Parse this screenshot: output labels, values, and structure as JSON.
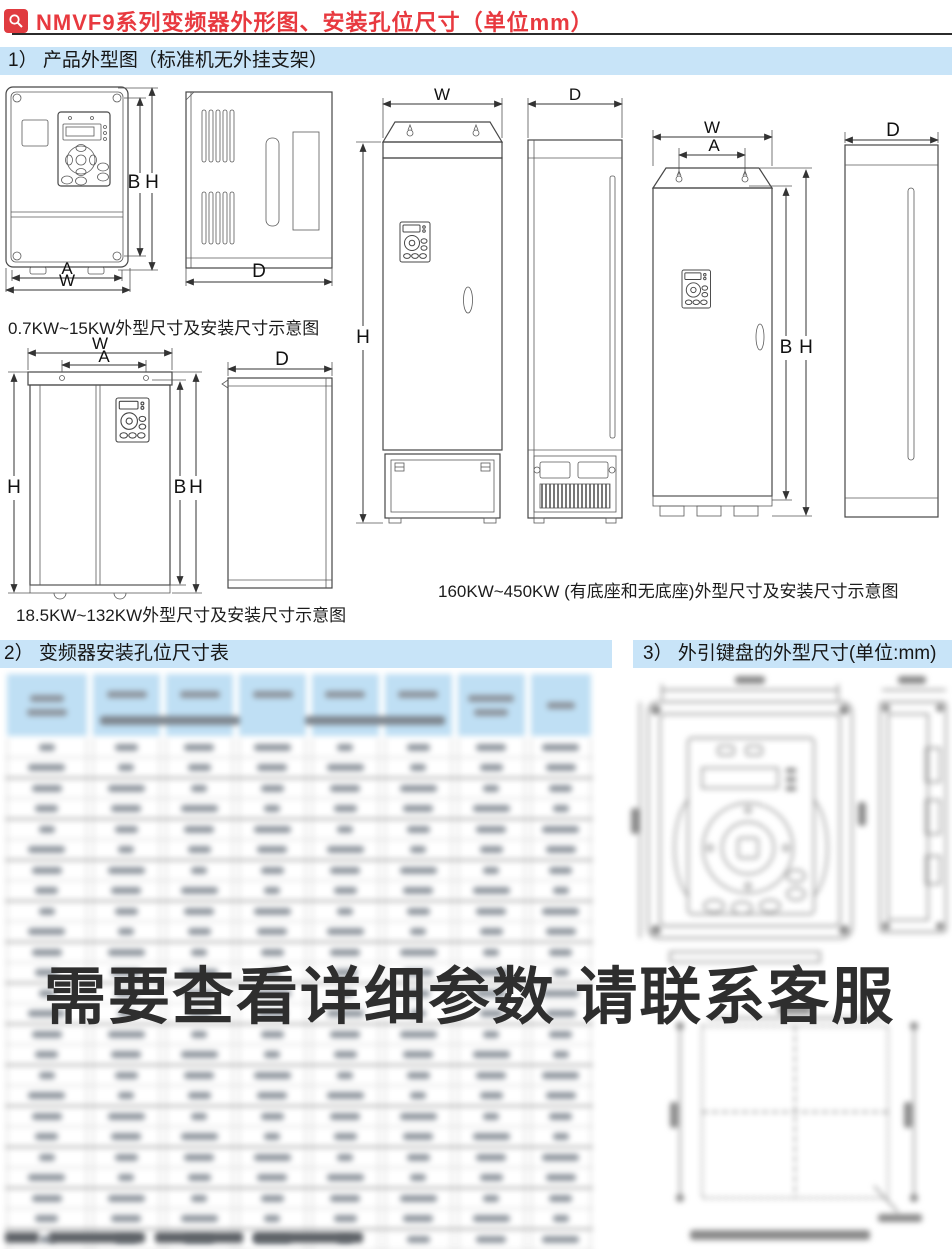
{
  "page": {
    "title": "NMVF9系列变频器外形图、安装孔位尺寸（单位mm）",
    "watermark": "需要查看详细参数 请联系客服"
  },
  "sections": {
    "s1_heading": "1） 产品外型图（标准机无外挂支架）",
    "s2_heading": "2） 变频器安装孔位尺寸表",
    "s3_heading": "3） 外引键盘的外型尺寸(单位:mm)"
  },
  "captions": {
    "small_range": "0.7KW~15KW外型尺寸及安装尺寸示意图",
    "medium_range": "18.5KW~132KW外型尺寸及安装尺寸示意图",
    "large_range": "160KW~450KW (有底座和无底座)外型尺寸及安装尺寸示意图"
  },
  "dim_labels": {
    "W": "W",
    "A": "A",
    "B": "B",
    "H": "H",
    "D": "D"
  },
  "icons": {
    "title_icon": "magnifier"
  },
  "colors": {
    "title_red": "#e8393f",
    "banner_blue": "#c8e4f8",
    "table_header_blue": "#bfdff4",
    "drawing_stroke": "#474747",
    "watermark_gray": "#2e2e2e"
  }
}
